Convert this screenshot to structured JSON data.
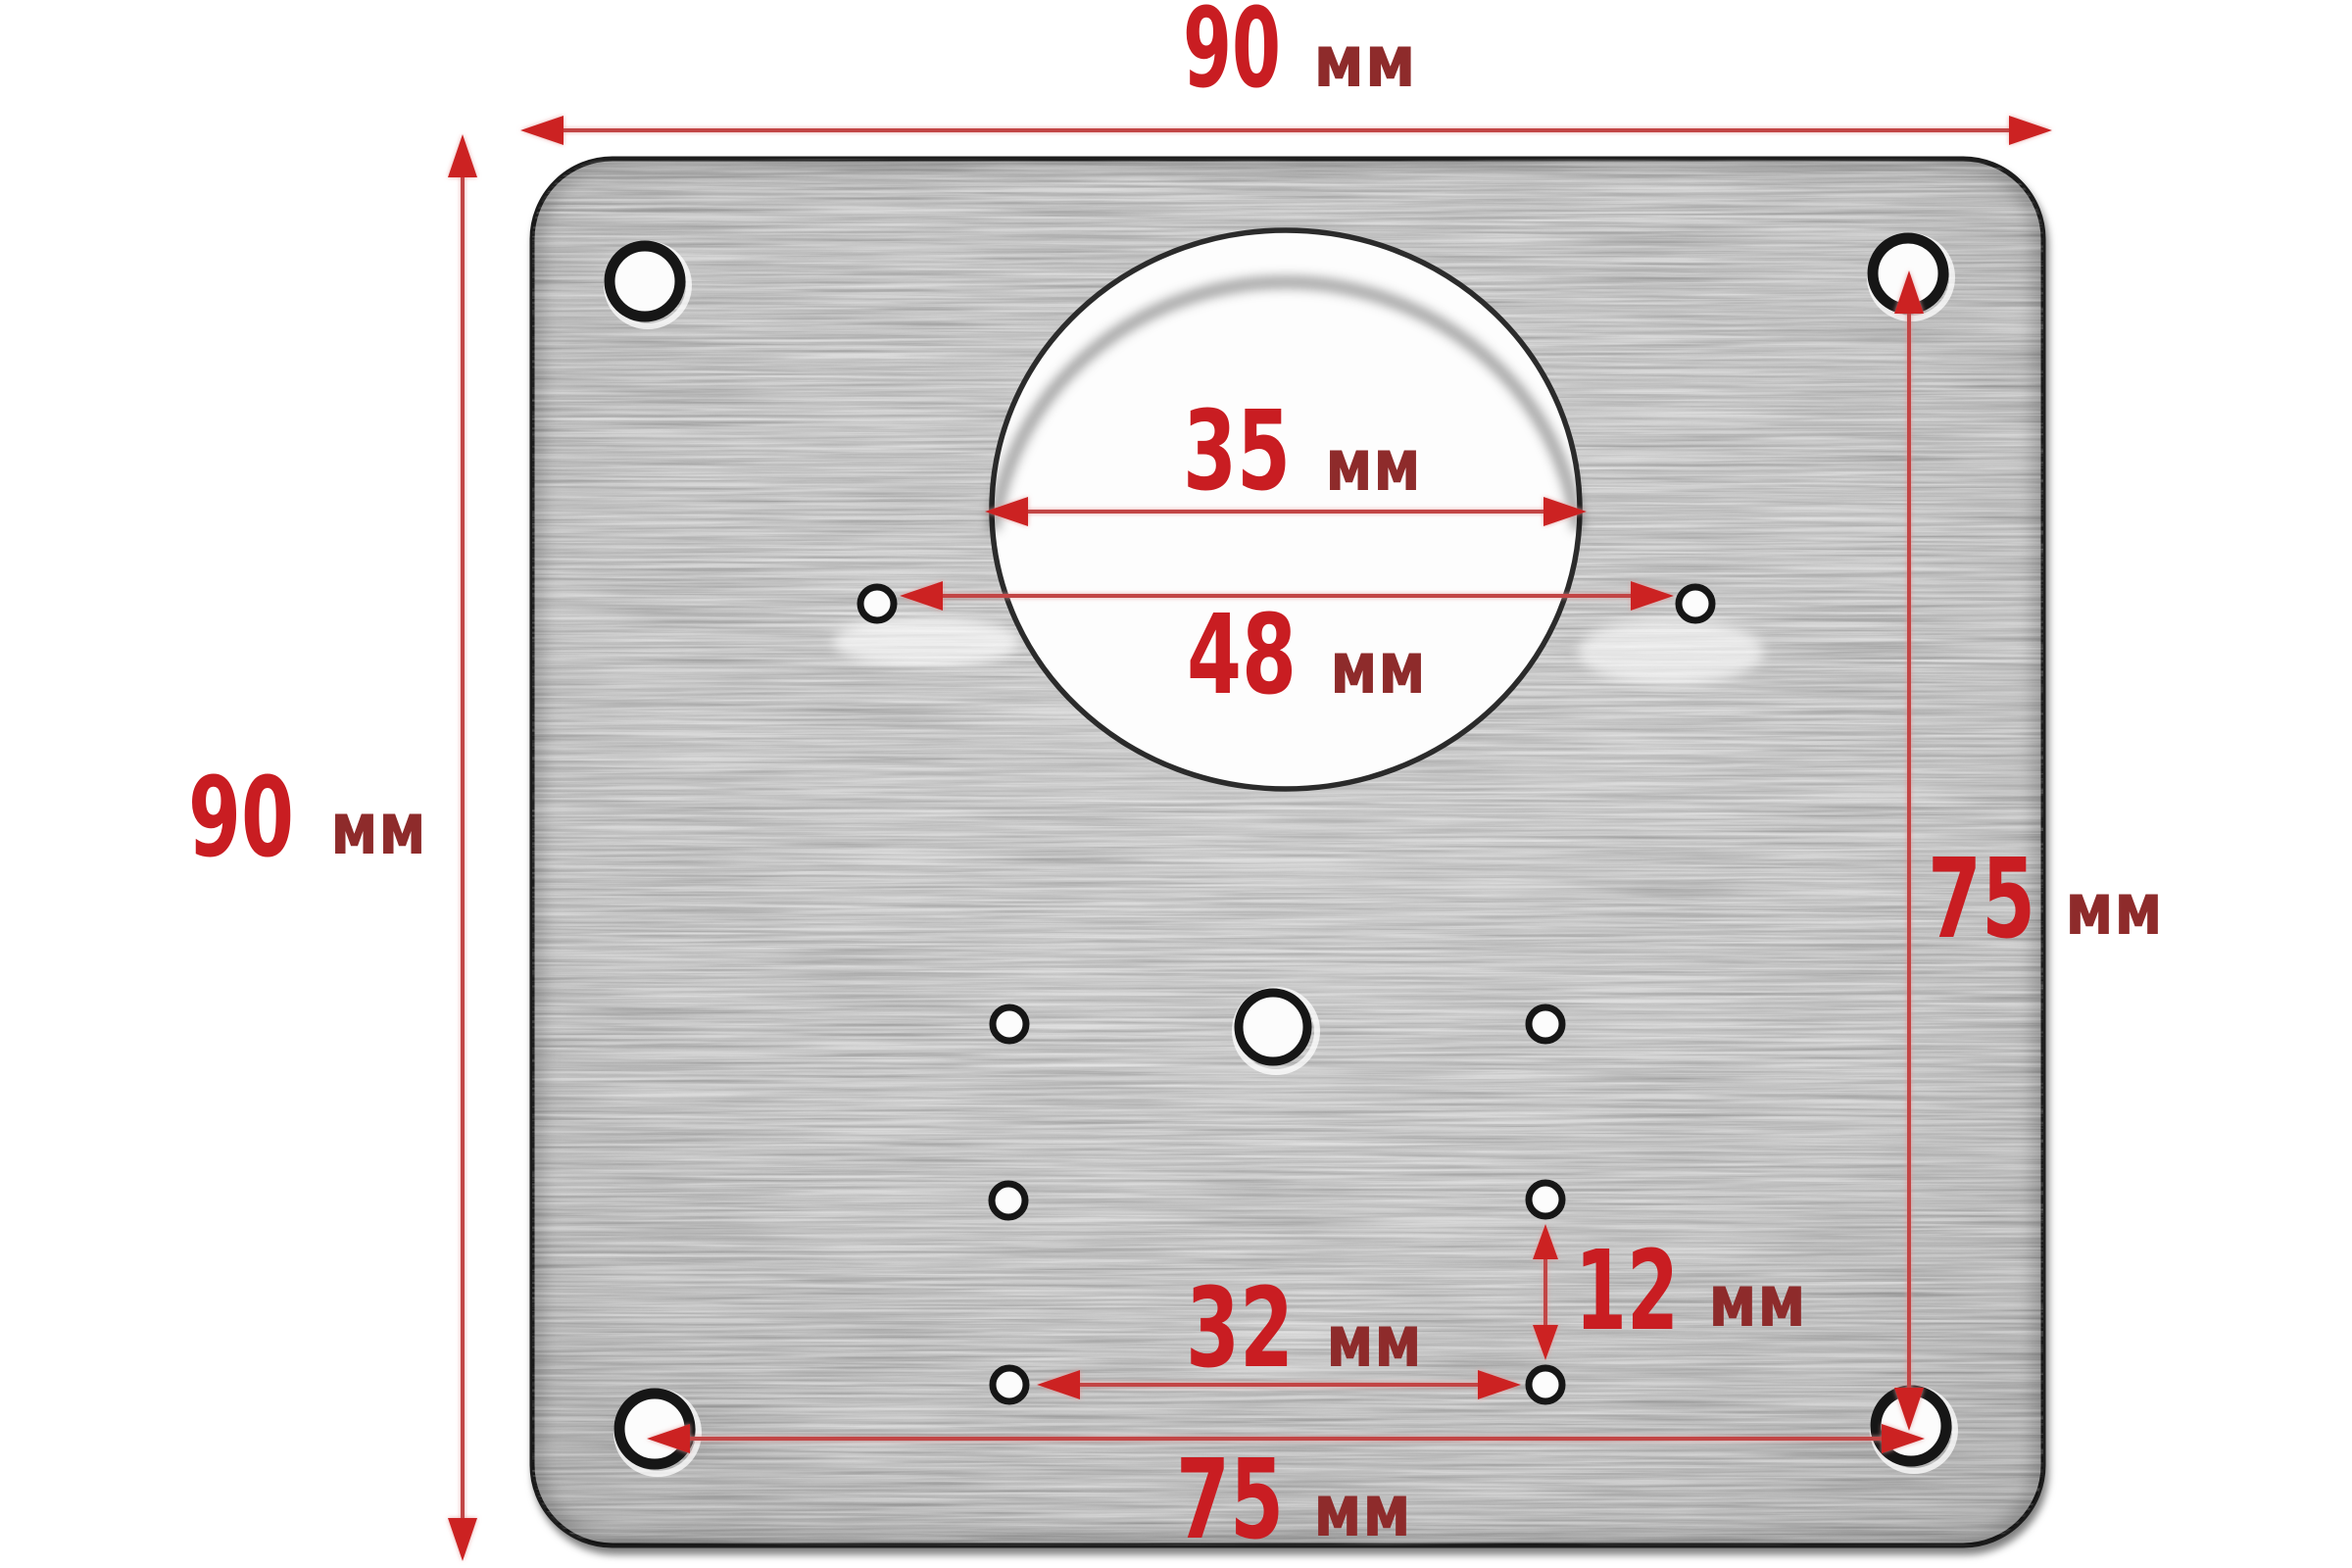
{
  "diagram": {
    "type": "dimensioned technical drawing",
    "subject": "square hinge mounting / repair plate with concealed-hinge cup hole",
    "unit_label": "мм",
    "dimensions": {
      "plate_width_top": {
        "value": "90",
        "unit": "мм"
      },
      "plate_height_left": {
        "value": "90",
        "unit": "мм"
      },
      "cup_hole_diameter": {
        "value": "35",
        "unit": "мм"
      },
      "pilot_hole_span": {
        "value": "48",
        "unit": "мм"
      },
      "corner_hole_vertical_span": {
        "value": "75",
        "unit": "мм"
      },
      "lower_hole_offset": {
        "value": "12",
        "unit": "мм"
      },
      "lower_hole_span": {
        "value": "32",
        "unit": "мм"
      },
      "corner_hole_horizontal_span": {
        "value": "75",
        "unit": "мм"
      }
    }
  },
  "colors": {
    "background": "#ffffff",
    "value-red": "#c91d22",
    "unit-red": "#8e2b2b",
    "line-red": "#c24444",
    "arrow-red": "#cc2323",
    "plate-fill": "#d3d3d3",
    "plate-edge": "#1a1a1a",
    "hole-fill": "#fcfcfc",
    "hole-ring": "#161616",
    "circle-edge": "#2b2b2b"
  }
}
